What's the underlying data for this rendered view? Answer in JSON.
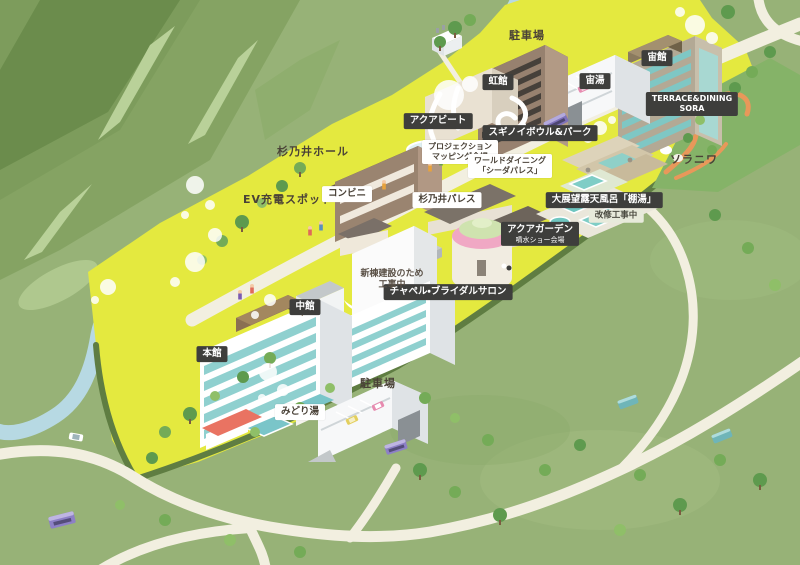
{
  "map": {
    "labels": {
      "parking_top": {
        "text": "駐車場"
      },
      "nijikan": {
        "text": "虹館"
      },
      "aquabeat": {
        "text": "アクアビート"
      },
      "sorakan": {
        "text": "宙館"
      },
      "sorayu": {
        "text": "宙湯"
      },
      "terrace_sora": {
        "line1": "TERRACE&DINING",
        "line2": "SORA"
      },
      "soraniwa": {
        "text": "ソラニワ"
      },
      "bowl_park": {
        "text": "スギノイボウル&パーク"
      },
      "projection": {
        "line1": "プロジェクション",
        "line2": "マッピング会場"
      },
      "world_dining": {
        "line1": "ワールドダイニング",
        "line2": "「シーダパレス」"
      },
      "suginoi_hall": {
        "text": "杉乃井ホール"
      },
      "ev_spot": {
        "text": "EV充電スポット"
      },
      "conbini": {
        "text": "コンビニ"
      },
      "suginoi_palace": {
        "text": "杉乃井パレス"
      },
      "tanayu": {
        "text": "大展望露天風呂「棚湯」"
      },
      "kaishu": {
        "text": "改修工事中"
      },
      "aqua_garden": {
        "text": "アクアガーデン",
        "sub": "噴水ショー会場"
      },
      "chapel": {
        "text": "チャペル・ブライダルサロン"
      },
      "construction": {
        "line1": "新棟建設のため",
        "line2": "工事中"
      },
      "nakakan": {
        "text": "中館"
      },
      "honkan": {
        "text": "本館"
      },
      "midoriyu": {
        "text": "みどり湯"
      },
      "parking_bottom": {
        "text": "駐車場"
      }
    },
    "colors": {
      "ground_green": "#97b277",
      "mountain_green": "#6b8c4c",
      "resort_yellow": "#e4e93f",
      "river_blue": "#b7d9e3",
      "road_cream": "#f2efe0",
      "hedge_green": "#5f7d42",
      "water_teal": "#6fc6c0",
      "path_orange": "#e8985a",
      "label_dark_bg": "#3e3e3c",
      "label_light_bg": "#ffffff",
      "label_text_dark": "#4a4237"
    }
  }
}
